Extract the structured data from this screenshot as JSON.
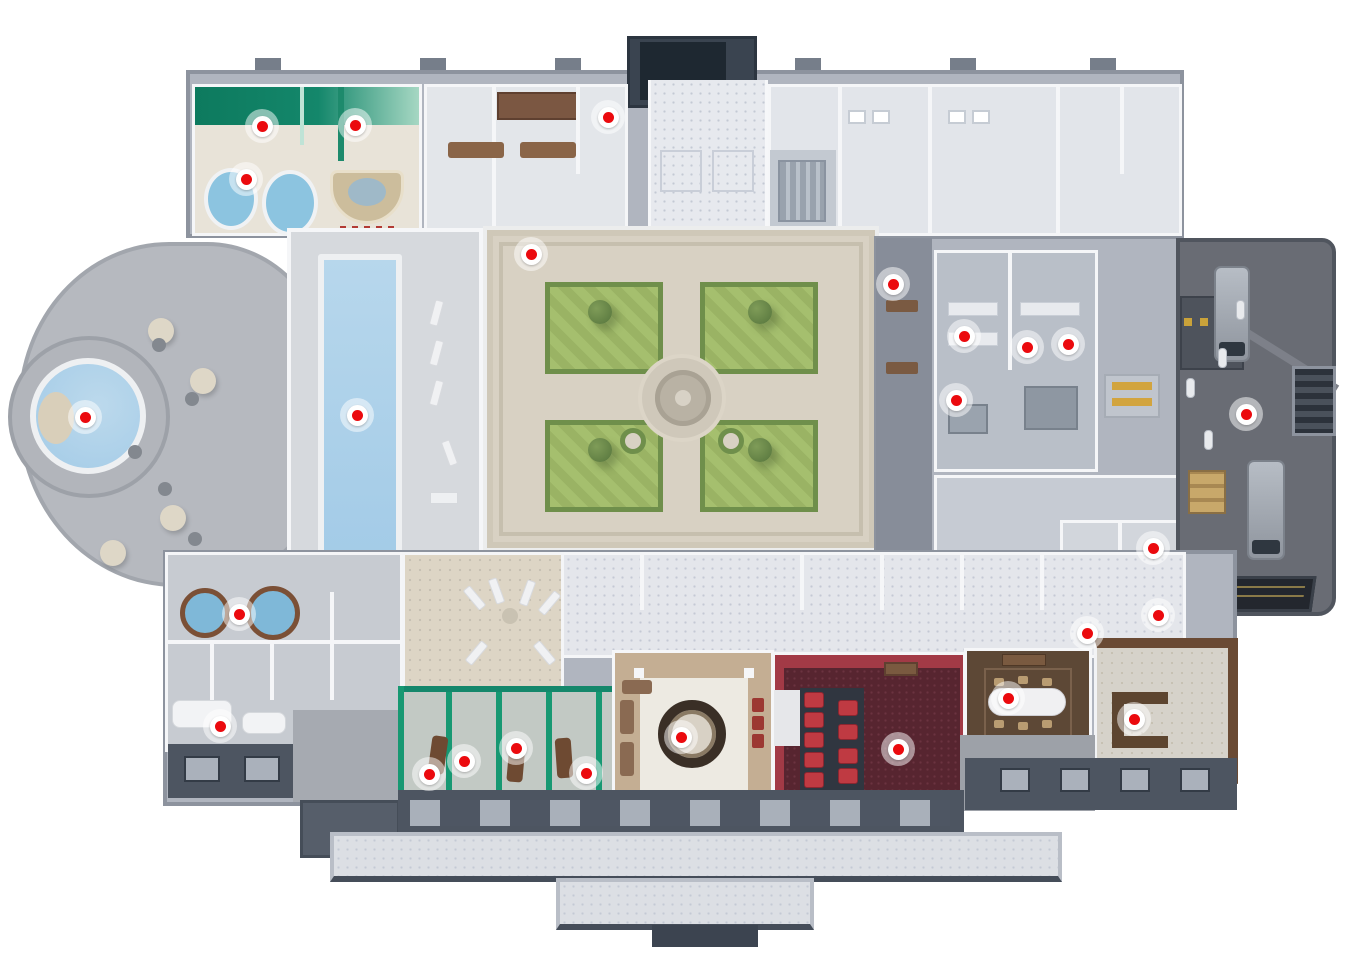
{
  "canvas": {
    "width": 1360,
    "height": 961
  },
  "view": {
    "type": "3d-floorplan",
    "floor_label": "",
    "visible_text": ""
  },
  "palette": {
    "marker_dot": "#eb0a0e",
    "marker_ring": "#ffffff",
    "marker_halo": "rgba(255,255,255,0.5)",
    "pool_water": "#a3cbe7",
    "grass": "#a5bf6e",
    "hedge": "#6f8f4b",
    "courtyard_paving": "#d8d1c3",
    "spa_wall_green": "#14876b",
    "cinema_carpet": "#572530",
    "cinema_wall": "#a23a46",
    "seat_red": "#bf3a42",
    "wood_floor": "#5d4836",
    "lounge_floor": "#c4ae93",
    "dock_asphalt": "#696c74",
    "facade_dark": "#4d5561",
    "building_gray": "#b0b5bf",
    "wall_white": "#f5f6f8"
  },
  "markers": [
    {
      "id": "spa-treatment-room-1",
      "x": 262,
      "y": 126
    },
    {
      "id": "spa-treatment-room-2",
      "x": 355,
      "y": 125
    },
    {
      "id": "spa-jacuzzi-lounge",
      "x": 246,
      "y": 179
    },
    {
      "id": "staff-room",
      "x": 608,
      "y": 117
    },
    {
      "id": "pool-hall-entrance",
      "x": 531,
      "y": 254
    },
    {
      "id": "outdoor-round-pool",
      "x": 85,
      "y": 417
    },
    {
      "id": "indoor-lap-pool",
      "x": 357,
      "y": 415
    },
    {
      "id": "service-corridor",
      "x": 893,
      "y": 284
    },
    {
      "id": "kitchen-station-1",
      "x": 964,
      "y": 336
    },
    {
      "id": "kitchen-station-2",
      "x": 1027,
      "y": 347
    },
    {
      "id": "kitchen-station-3",
      "x": 1068,
      "y": 344
    },
    {
      "id": "main-kitchen",
      "x": 956,
      "y": 400
    },
    {
      "id": "loading-dock",
      "x": 1246,
      "y": 414
    },
    {
      "id": "hot-tub-room",
      "x": 239,
      "y": 614
    },
    {
      "id": "utility-room-1",
      "x": 1153,
      "y": 548
    },
    {
      "id": "utility-room-2",
      "x": 1158,
      "y": 615
    },
    {
      "id": "storage-room",
      "x": 1087,
      "y": 633
    },
    {
      "id": "changing-lounge",
      "x": 220,
      "y": 726
    },
    {
      "id": "massage-room-1",
      "x": 429,
      "y": 774
    },
    {
      "id": "massage-room-2",
      "x": 464,
      "y": 761
    },
    {
      "id": "massage-room-3",
      "x": 516,
      "y": 748
    },
    {
      "id": "massage-room-4",
      "x": 586,
      "y": 773
    },
    {
      "id": "grand-lounge",
      "x": 681,
      "y": 737
    },
    {
      "id": "cinema-room",
      "x": 898,
      "y": 749
    },
    {
      "id": "dining-room",
      "x": 1008,
      "y": 698
    },
    {
      "id": "pergola-terrace",
      "x": 1134,
      "y": 719
    }
  ]
}
